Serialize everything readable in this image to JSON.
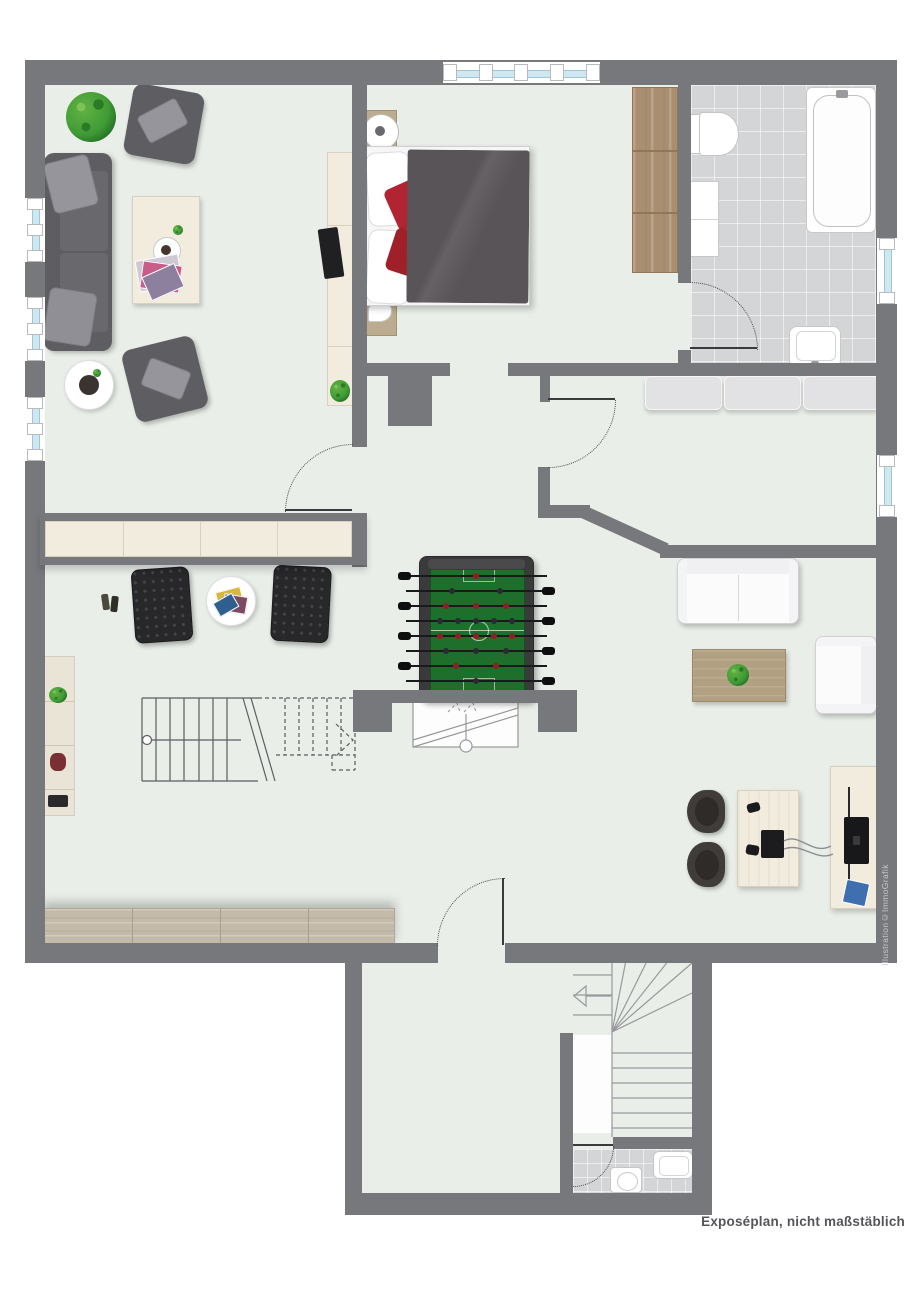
{
  "labels": {
    "disclaimer": "Exposéplan, nicht maßstäblich",
    "credit": "Illustration©ImmoGrafik"
  },
  "colors": {
    "bg": "#ffffff",
    "floor": "#e9eee8",
    "wall": "#77787c",
    "tile": "#d4d5d7",
    "windowGlass": "#cfe7f0",
    "windowFrame": "#b9babc",
    "cream": "#f2ecdf",
    "creamLine": "#d9d1bf",
    "woodLight": "#bcac8f",
    "woodMid": "#b2a083",
    "woodDark": "#a98f70",
    "plankWood": "#c4baa9",
    "sofaDark": "#5d5d62",
    "cushionLight": "#96959b",
    "chairBlack": "#28282b",
    "duvet": "#595457",
    "pillowRed": "#b02531",
    "whiteFurniture": "#fbfbfb",
    "outline": "#d2d2d4",
    "foosFrame": "#3a3a3d",
    "foosField": "#1f6f2c",
    "playerRed": "#8d2026",
    "playerDark": "#2a2a33",
    "plantGreen": "#3f9b35",
    "stairLine": "#5c5d61",
    "stairLightLine": "#98999d",
    "doorLine": "#3a3a3c",
    "textDark": "#55565a",
    "textCredit": "#c7c8ca"
  }
}
